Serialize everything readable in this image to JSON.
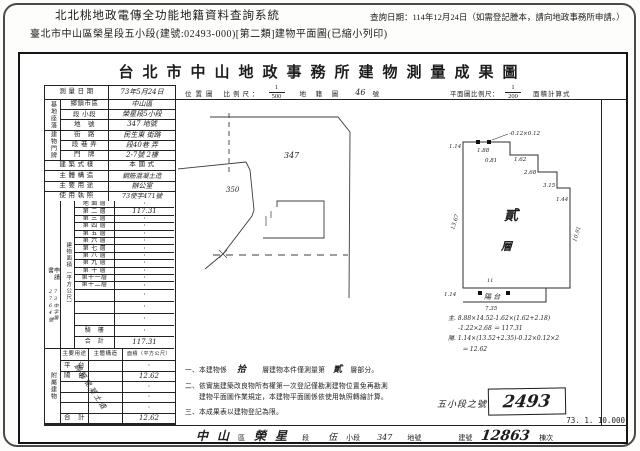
{
  "header": {
    "system_title": "北北桃地政電傳全功能地籍資料查詢系統",
    "query_date": "查詢日期：114年12月24日（如需登記謄本，請向地政事務所申請。）",
    "doc_line": "臺北市中山區榮星段五小段(建號:02493-000)[第二類]建物平面圖(已縮小列印)"
  },
  "form": {
    "title": "台北市中山地政事務所建物測量成果圖",
    "survey": {
      "label": "測 量 日 期",
      "value": "73年5月24日"
    },
    "scales": {
      "location_label": "位置圖",
      "ratio_label": "比例尺：",
      "loc_num": "1",
      "loc_den": "500",
      "cadastral_label": "地 籍 圖",
      "cadastral_value": "46",
      "cadastral_unit": "號",
      "plan_label": "平面圖比例尺：",
      "plan_num": "1",
      "plan_den": "200",
      "calc_label": "面積計算式"
    },
    "site": {
      "group": "基地座落",
      "rows": [
        {
          "label": "鄉鎮市區",
          "value": "中山區"
        },
        {
          "label": "段 小段",
          "value": "榮星段5小段"
        },
        {
          "label": "地　號",
          "value": "347 地號"
        }
      ]
    },
    "door": {
      "group": "建物門牌",
      "rows": [
        {
          "label": "街　路",
          "value": "民生東 街路"
        },
        {
          "label": "段 巷 弄",
          "value": "段40巷 弄"
        },
        {
          "label": "門　牌",
          "value": "2-7號 2樓"
        }
      ]
    },
    "attrs": [
      {
        "label": "建 築 式 樣",
        "value": "本 國 式"
      },
      {
        "label": "主 體 構 造",
        "value": "鋼筋混凝土造"
      },
      {
        "label": "主 要 用 途",
        "value": "辦公室"
      },
      {
        "label": "使 用 執 照",
        "value": "73使字471號"
      }
    ],
    "apply": {
      "label": "申請書",
      "number": "73中字第2764號"
    },
    "floor_area": {
      "group": "建物面積（平方公尺）",
      "rows": [
        {
          "label": "地 面 層",
          "value": "·"
        },
        {
          "label": "第 二 層",
          "value": "117.31"
        },
        {
          "label": "第 三 層",
          "value": "·"
        },
        {
          "label": "第 四 層",
          "value": "·"
        },
        {
          "label": "第 五 層",
          "value": "·"
        },
        {
          "label": "第 六 層",
          "value": "·"
        },
        {
          "label": "第 七 層",
          "value": "·"
        },
        {
          "label": "第 八 層",
          "value": "·"
        },
        {
          "label": "第 九 層",
          "value": "·"
        },
        {
          "label": "第 十 層",
          "value": "·"
        },
        {
          "label": "第十一層",
          "value": "·"
        },
        {
          "label": "第十二層",
          "value": "·"
        },
        {
          "label": "",
          "value": "·"
        },
        {
          "label": "",
          "value": "·"
        },
        {
          "label": "",
          "value": "·"
        },
        {
          "label": "騎　樓",
          "value": "·"
        },
        {
          "label": "合　計",
          "value": "117.31"
        }
      ]
    },
    "attached": {
      "group": "附屬建物",
      "headers": {
        "use": "主要用途",
        "structure": "主體構造",
        "area": "面積（平方公尺）"
      },
      "diagonal": "鋼筋混凝土造",
      "rows": [
        {
          "use": "平　台",
          "area": "·"
        },
        {
          "use": "陽　台",
          "area": "12.62"
        },
        {
          "use": "",
          "area": "·"
        },
        {
          "use": "",
          "area": "·"
        },
        {
          "use": "",
          "area": "·"
        },
        {
          "use": "合　計",
          "area": "12.62"
        }
      ]
    },
    "location_map": {
      "parcel_main": "347",
      "parcel_left": "350"
    },
    "floor_plan": {
      "center_char1": "貳",
      "center_char2": "層",
      "balcony": "陽  台",
      "dims": {
        "d1": "1.14",
        "d2": "1.88",
        "d3": "0.81",
        "d4": "-0.12×0.12",
        "d5": "1.62",
        "d6": "2.68",
        "d7": "3.15",
        "d8": "1.44",
        "d9": "13.67",
        "d10": "10.91",
        "d11": "11",
        "d12": "1.14",
        "d13": "7.35"
      },
      "calc": {
        "l1": "主. 8.88×14.52-1.62×(1.62+2.18)",
        "l2": "-1.22×2.68 ＝ 117.31",
        "l3": "陽. 1.14×(13.52+2.35)-0.12×0.12×2",
        "l4": "＝ 12.62"
      }
    },
    "notes": {
      "n1a": "一、本建物係",
      "n1_hand1": "拾",
      "n1b": "層建物本件僅測量第",
      "n1_hand2": "貳",
      "n1c": "層部分。",
      "n2": "二、依實施建築改良物所有權第一次登記僅勘測建物位置免再勘測",
      "n2b": "建物平面圖作業規定，本建物平面圖係依使用執照轉繪計算。",
      "n3": "三、本成果表以建物登記為限。"
    },
    "stamp": {
      "label": "五小段之號",
      "value": "2493"
    },
    "scale_note": "73. 1. 10.000",
    "strip": {
      "i1": "中",
      "i2": "山",
      "i3": "區",
      "i4": "榮",
      "i5": "星",
      "i6": "段",
      "i7": "伍",
      "i8": "小段",
      "i9": "347",
      "i10": "地號",
      "i11": "建號",
      "i12": "12863",
      "i13": "棟次"
    }
  }
}
